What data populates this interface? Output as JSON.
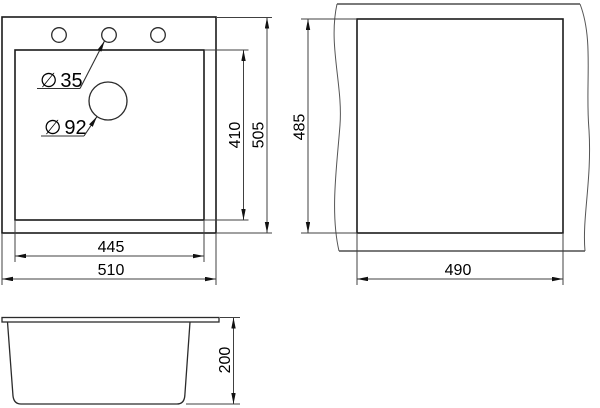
{
  "canvas": {
    "background": "#ffffff",
    "line_color": "#1a1a1a",
    "dimension_color": "#404040",
    "text_color": "#000000"
  },
  "views": {
    "top_view": {
      "faucet_hole": {
        "symbol": "∅",
        "value": "35"
      },
      "drain_hole": {
        "symbol": "∅",
        "value": "92"
      },
      "dims": {
        "inner_width": "445",
        "outer_width": "510",
        "inner_depth": "410",
        "outer_depth": "505"
      }
    },
    "cutout_view": {
      "dims": {
        "width": "490",
        "height": "485"
      }
    },
    "front_view": {
      "dims": {
        "height": "200"
      }
    }
  }
}
